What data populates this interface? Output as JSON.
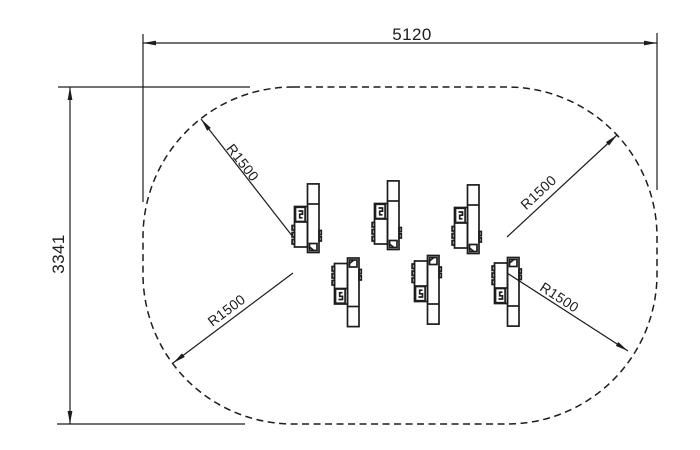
{
  "drawing": {
    "background_color": "#ffffff",
    "line_color": "#1d1d1d",
    "dimensions": {
      "width": {
        "label": "5120"
      },
      "height": {
        "label": "3341"
      }
    },
    "radius_callouts": [
      {
        "label": "R1500",
        "position": "top-left"
      },
      {
        "label": "R1500",
        "position": "top-right"
      },
      {
        "label": "R1500",
        "position": "bottom-left"
      },
      {
        "label": "R1500",
        "position": "bottom-right"
      }
    ],
    "safety_zone": {
      "outline_style": "dashed",
      "corner_radius_label": "R1500"
    },
    "machines": [
      {
        "row": "top",
        "tx": 291.5,
        "ty": 183,
        "flipped": false
      },
      {
        "row": "top",
        "tx": 371.5,
        "ty": 180,
        "flipped": false
      },
      {
        "row": "top",
        "tx": 451.5,
        "ty": 184,
        "flipped": false
      },
      {
        "row": "bottom",
        "tx": 331.5,
        "ty": 327.5,
        "flipped": true
      },
      {
        "row": "bottom",
        "tx": 411.5,
        "ty": 325,
        "flipped": true
      },
      {
        "row": "bottom",
        "tx": 491.5,
        "ty": 327,
        "flipped": true
      }
    ]
  }
}
